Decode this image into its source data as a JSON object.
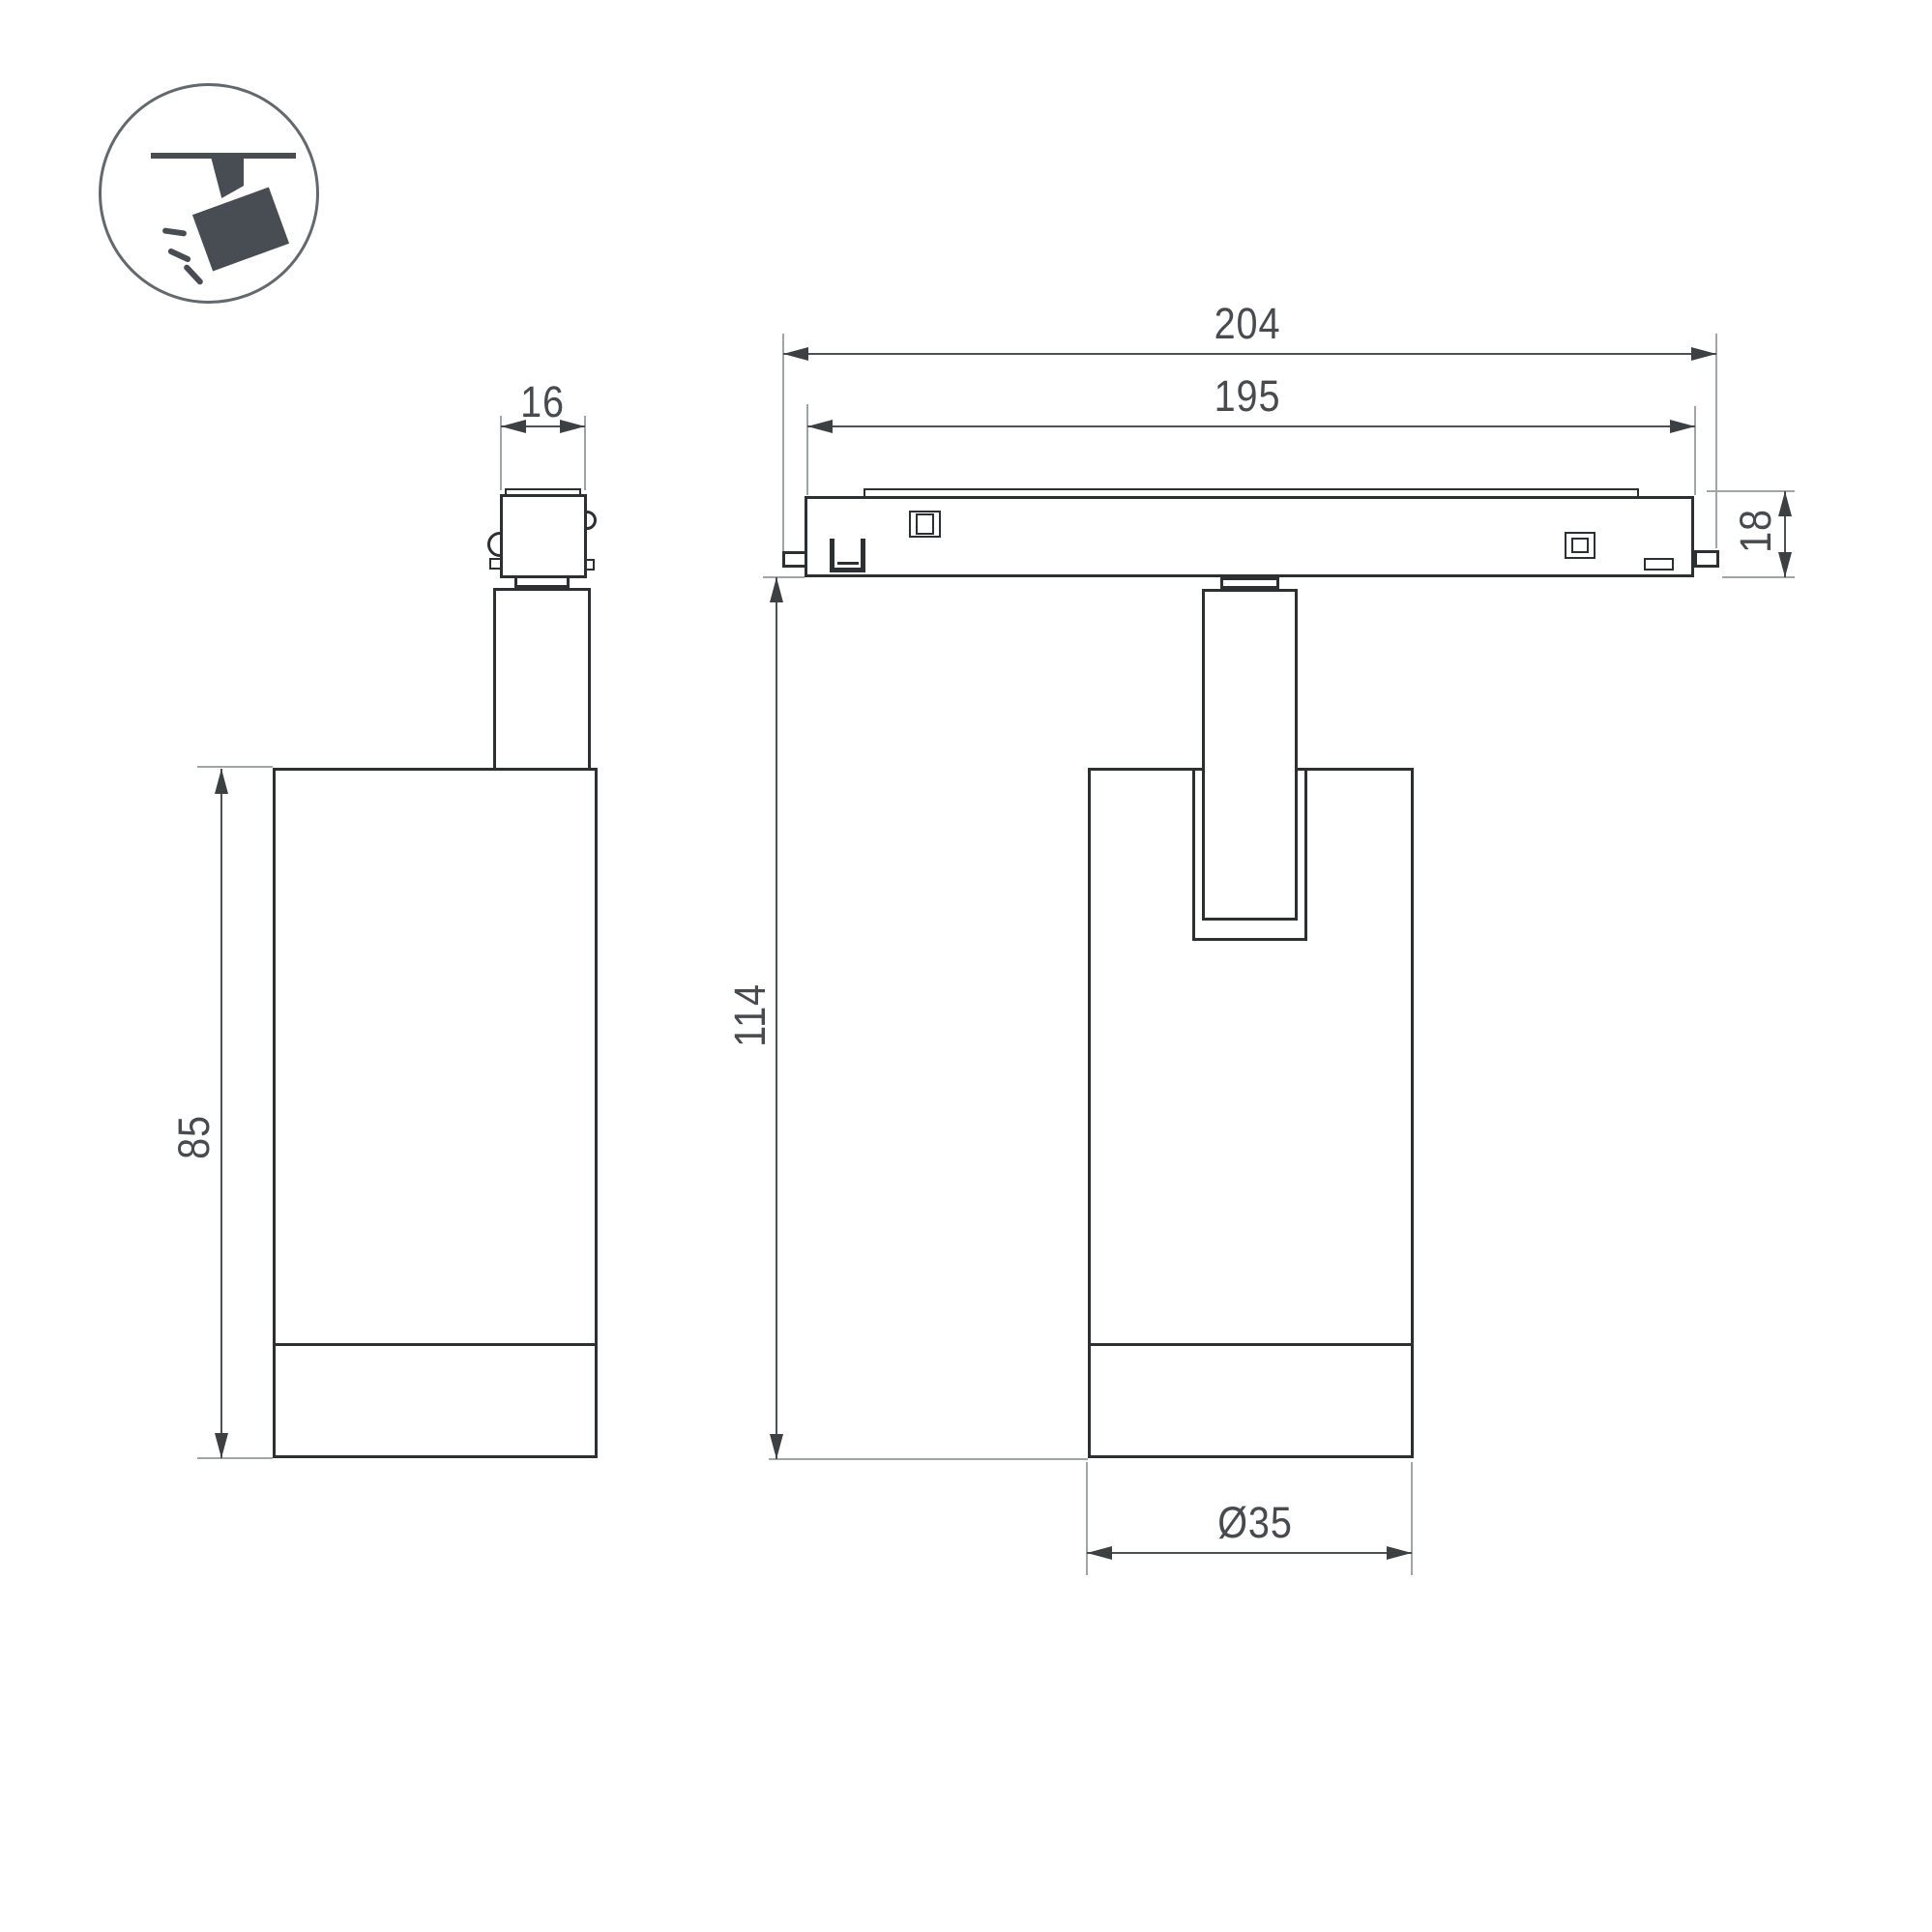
{
  "title": "Track spotlight dimensional drawing",
  "icon": {
    "name": "ceiling-track-spotlight-icon"
  },
  "views": {
    "side_view": {
      "dim_adapter_width": "16",
      "dim_body_height": "85"
    },
    "front_view": {
      "dim_total_length": "204",
      "dim_rail_length": "195",
      "dim_rail_height": "18",
      "dim_overall_height": "114",
      "dim_body_diameter": "Ø35"
    }
  },
  "colors": {
    "outline": "#2c3033",
    "dimension_line": "#4e5255",
    "extension_line": "#a2a5a8",
    "text": "#474b4f",
    "icon_fill": "#474d52"
  }
}
